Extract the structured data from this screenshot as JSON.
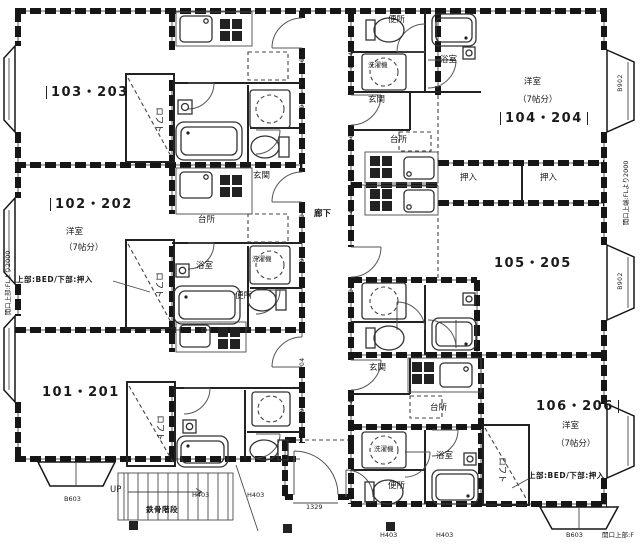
{
  "units": {
    "u101": {
      "id": "101・201"
    },
    "u102": {
      "id": "102・202",
      "room_type": "洋室",
      "room_size": "（7帖分）",
      "loft_note": "上部:BED/下部:押入"
    },
    "u103": {
      "id": "103・203"
    },
    "u104": {
      "id": "104・204",
      "room_type": "洋室",
      "room_size": "（7帖分）"
    },
    "u105": {
      "id": "105・205"
    },
    "u106": {
      "id": "106・206",
      "room_type": "洋室",
      "room_size": "（7帖分）",
      "loft_note": "上部:BED/下部:押入"
    }
  },
  "room_labels": {
    "loft": "ロフト",
    "kitchen": "台所",
    "entrance": "玄関",
    "bathroom": "浴室",
    "toilet": "便所",
    "washer": "洗濯機",
    "closet": "押入",
    "corridor": "廊下"
  },
  "stairs": {
    "label": "鉄骨階段",
    "up": "UP"
  },
  "dimensions": {
    "opening_0904": "0904",
    "door_h403": "H403",
    "balcony_b603": "B603",
    "window_b902": "B902",
    "entry_width_1329": "1329",
    "left_wall_note": "開口上部:FLより2000",
    "right_wall_note": "開口上端:FLより2000",
    "bottom_right_note": "開口上部:F"
  },
  "colors": {
    "ink": "#1a1a1a",
    "paper": "#ffffff"
  }
}
